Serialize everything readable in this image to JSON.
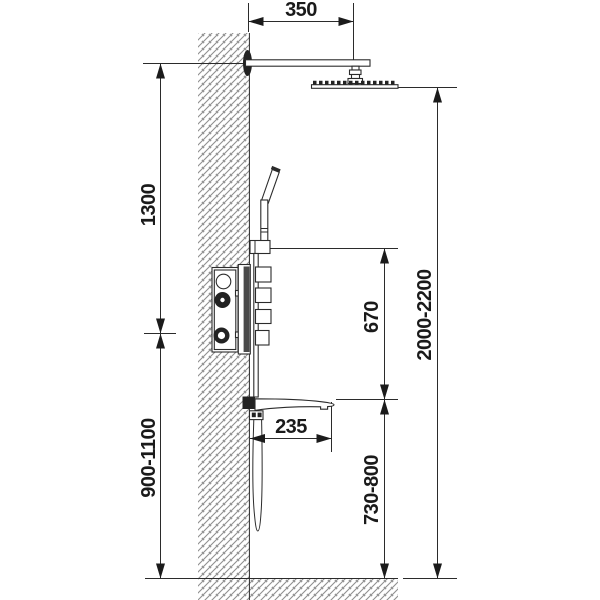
{
  "diagram": {
    "title": "Wall-mounted shower system installation drawing (side view)",
    "units": "mm",
    "colors": {
      "background": "#ffffff",
      "line": "#2b2b2b",
      "hatch": "#8f8f8f",
      "text": "#1a1a1a",
      "panel_dark": "#4a4a4a"
    },
    "components": [
      "wall",
      "floor",
      "shower-arm",
      "rain-shower-head",
      "hand-shower",
      "hand-shower-holder",
      "mixer-control-panel",
      "spout-shelf",
      "shower-hose"
    ],
    "dimensions": [
      {
        "name": "shower-arm-projection",
        "label": "350",
        "orientation": "horizontal"
      },
      {
        "name": "arm-to-mixer-distance",
        "label": "1300",
        "orientation": "vertical"
      },
      {
        "name": "mixer-height-from-floor",
        "label": "900-1100",
        "orientation": "vertical"
      },
      {
        "name": "holder-to-spout-distance",
        "label": "670",
        "orientation": "vertical"
      },
      {
        "name": "spout-projection",
        "label": "235",
        "orientation": "horizontal"
      },
      {
        "name": "spout-height-from-floor",
        "label": "730-800",
        "orientation": "vertical"
      },
      {
        "name": "head-height-from-floor",
        "label": "2000-2200",
        "orientation": "vertical"
      }
    ]
  }
}
